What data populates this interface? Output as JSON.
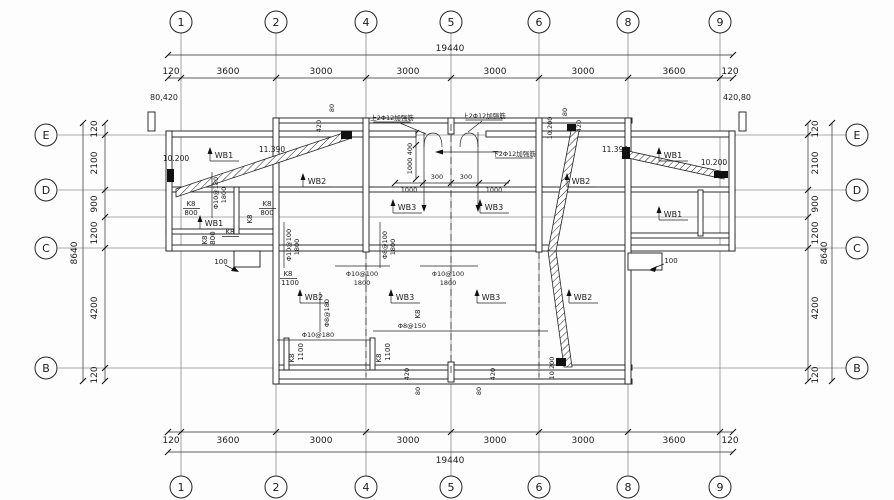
{
  "drawing": {
    "background": "#fdfdfd",
    "line_color": "#1a1a1a",
    "axis": {
      "cols": [
        {
          "label": "1",
          "x": 181
        },
        {
          "label": "2",
          "x": 276
        },
        {
          "label": "4",
          "x": 366
        },
        {
          "label": "5",
          "x": 451
        },
        {
          "label": "6",
          "x": 539
        },
        {
          "label": "8",
          "x": 628
        },
        {
          "label": "9",
          "x": 720
        }
      ],
      "rows": [
        {
          "label": "E",
          "y": 135
        },
        {
          "label": "D",
          "y": 190
        },
        {
          "label": "C",
          "y": 248
        },
        {
          "label": "B",
          "y": 368
        }
      ],
      "sub_rows": [
        217
      ]
    },
    "dims": {
      "top": {
        "total": {
          "t": "19440",
          "line_y": 55,
          "text_y": 51,
          "text_x": 450,
          "ticks": [
            168,
            733
          ]
        },
        "segments": {
          "line_y": 78,
          "text_y": 74,
          "ticks": [
            168,
            181,
            276,
            366,
            451,
            539,
            628,
            720,
            733
          ],
          "labels": [
            {
              "t": "120",
              "x": 171
            },
            {
              "t": "3600",
              "x": 228
            },
            {
              "t": "3000",
              "x": 321
            },
            {
              "t": "3000",
              "x": 408
            },
            {
              "t": "3000",
              "x": 495
            },
            {
              "t": "3000",
              "x": 583
            },
            {
              "t": "3600",
              "x": 674
            },
            {
              "t": "120",
              "x": 730
            }
          ]
        }
      },
      "bottom": {
        "segments": {
          "line_y": 432,
          "text_y": 443,
          "ticks": [
            168,
            181,
            276,
            366,
            451,
            539,
            628,
            720,
            733
          ],
          "labels": [
            {
              "t": "120",
              "x": 171
            },
            {
              "t": "3600",
              "x": 228
            },
            {
              "t": "3000",
              "x": 321
            },
            {
              "t": "3000",
              "x": 408
            },
            {
              "t": "3000",
              "x": 495
            },
            {
              "t": "3000",
              "x": 583
            },
            {
              "t": "3600",
              "x": 674
            },
            {
              "t": "120",
              "x": 730
            }
          ]
        },
        "total": {
          "t": "19440",
          "line_y": 452,
          "text_y": 463,
          "text_x": 450,
          "ticks": [
            168,
            733
          ]
        }
      },
      "left": {
        "segments": {
          "line_x": 105,
          "text_x": 97,
          "ticks": [
            123,
            135,
            190,
            217,
            248,
            368,
            381
          ],
          "labels": [
            {
              "t": "120",
              "y": 129
            },
            {
              "t": "2100",
              "y": 163
            },
            {
              "t": "900",
              "y": 204
            },
            {
              "t": "1200",
              "y": 233
            },
            {
              "t": "4200",
              "y": 308
            },
            {
              "t": "120",
              "y": 375
            }
          ]
        },
        "total": {
          "t": "8640",
          "line_x": 83,
          "text_x": 77,
          "text_y": 253,
          "ticks": [
            123,
            381
          ]
        }
      },
      "right": {
        "segments": {
          "line_x": 808,
          "text_x": 818,
          "ticks": [
            123,
            135,
            190,
            217,
            248,
            368,
            381
          ],
          "labels": [
            {
              "t": "120",
              "y": 129
            },
            {
              "t": "2100",
              "y": 163
            },
            {
              "t": "900",
              "y": 204
            },
            {
              "t": "1200",
              "y": 233
            },
            {
              "t": "4200",
              "y": 308
            },
            {
              "t": "120",
              "y": 375
            }
          ]
        },
        "total": {
          "t": "8640",
          "line_x": 832,
          "text_x": 827,
          "text_y": 253,
          "ticks": [
            123,
            381
          ]
        }
      },
      "corner_notes": [
        {
          "t": "80,420",
          "x": 164,
          "y": 100
        },
        {
          "t": "420,80",
          "x": 737,
          "y": 100
        }
      ]
    },
    "plan_labels": [
      {
        "t": "10.200",
        "x": 176,
        "y": 161,
        "fs": 7.5
      },
      {
        "t": "WB1",
        "x": 224,
        "y": 158,
        "wb": 1
      },
      {
        "t": "11.390",
        "x": 272,
        "y": 152,
        "fs": 7.5
      },
      {
        "t": "WB2",
        "x": 317,
        "y": 184,
        "wb": 1
      },
      {
        "t": "上2Φ12加强筋",
        "x": 392,
        "y": 120,
        "fs": 6.5,
        "ul": 1
      },
      {
        "t": "上2Φ12加强筋",
        "x": 484,
        "y": 118,
        "fs": 6.5,
        "ul": 1
      },
      {
        "t": "下2Φ12加强筋",
        "x": 514,
        "y": 156,
        "fs": 6.5,
        "ul": 1
      },
      {
        "t": "400",
        "x": 412,
        "y": 149,
        "r": 1,
        "fs": 6.5
      },
      {
        "t": "1000",
        "x": 412,
        "y": 166,
        "r": 1,
        "fs": 6.5
      },
      {
        "t": "300",
        "x": 437,
        "y": 179,
        "fs": 6.5
      },
      {
        "t": "300",
        "x": 466,
        "y": 179,
        "fs": 6.5
      },
      {
        "t": "1000",
        "x": 409,
        "y": 192,
        "fs": 6.5
      },
      {
        "t": "1000",
        "x": 494,
        "y": 192,
        "fs": 6.5
      },
      {
        "t": "80",
        "x": 334,
        "y": 108,
        "r": 1,
        "fs": 6.5
      },
      {
        "t": "420",
        "x": 321,
        "y": 126,
        "r": 1,
        "fs": 6.5
      },
      {
        "t": "10.200",
        "x": 552,
        "y": 128,
        "r": 1,
        "fs": 6.5
      },
      {
        "t": "80",
        "x": 567,
        "y": 112,
        "r": 1,
        "fs": 6.5
      },
      {
        "t": "420",
        "x": 581,
        "y": 126,
        "r": 1,
        "fs": 6.5
      },
      {
        "t": "WB2",
        "x": 581,
        "y": 184,
        "wb": 1
      },
      {
        "t": "11.390",
        "x": 615,
        "y": 152,
        "fs": 7.5
      },
      {
        "t": "WB1",
        "x": 673,
        "y": 158,
        "wb": 1
      },
      {
        "t": "10.200",
        "x": 714,
        "y": 165,
        "fs": 7.5
      },
      {
        "t": "K8",
        "x": 191,
        "y": 206,
        "fs": 7,
        "fr": 1
      },
      {
        "t": "800",
        "x": 191,
        "y": 215,
        "fs": 7
      },
      {
        "t": "K8",
        "x": 267,
        "y": 206,
        "fs": 7,
        "fr": 1
      },
      {
        "t": "800",
        "x": 267,
        "y": 215,
        "fs": 7
      },
      {
        "t": "WB1",
        "x": 214,
        "y": 226,
        "wb": 1
      },
      {
        "t": "K8",
        "x": 230,
        "y": 234,
        "fs": 7,
        "fr": 1
      },
      {
        "t": "K8",
        "x": 252,
        "y": 219,
        "r": 1,
        "fs": 7
      },
      {
        "t": "Φ10@180",
        "x": 218,
        "y": 193,
        "r": 1,
        "fs": 6.5
      },
      {
        "t": "1800",
        "x": 226,
        "y": 195,
        "r": 1,
        "fs": 6.5
      },
      {
        "t": "K8",
        "x": 207,
        "y": 240,
        "r": 1,
        "fs": 7
      },
      {
        "t": "800",
        "x": 215,
        "y": 238,
        "r": 1,
        "fs": 7
      },
      {
        "t": "WB3",
        "x": 407,
        "y": 210,
        "wb": 1
      },
      {
        "t": "WB3",
        "x": 494,
        "y": 210,
        "wb": 1
      },
      {
        "t": "WB1",
        "x": 673,
        "y": 217,
        "wb": 1
      },
      {
        "t": "100",
        "x": 221,
        "y": 264,
        "fs": 7
      },
      {
        "t": "100",
        "x": 671,
        "y": 263,
        "fs": 7
      },
      {
        "t": "Φ10@100",
        "x": 291,
        "y": 245,
        "r": 1,
        "fs": 6.5
      },
      {
        "t": "1800",
        "x": 299,
        "y": 247,
        "r": 1,
        "fs": 6.5
      },
      {
        "t": "Φ8@100",
        "x": 387,
        "y": 245,
        "r": 1,
        "fs": 6.5
      },
      {
        "t": "1800",
        "x": 395,
        "y": 247,
        "r": 1,
        "fs": 6.5
      },
      {
        "t": "Φ10@100",
        "x": 362,
        "y": 276,
        "fs": 6.5
      },
      {
        "t": "1800",
        "x": 362,
        "y": 285,
        "fs": 6.5
      },
      {
        "t": "Φ10@100",
        "x": 448,
        "y": 276,
        "fs": 6.5
      },
      {
        "t": "1800",
        "x": 448,
        "y": 285,
        "fs": 6.5
      },
      {
        "t": "K8",
        "x": 288,
        "y": 276,
        "fs": 7,
        "fr": 1
      },
      {
        "t": "1100",
        "x": 290,
        "y": 285,
        "fs": 7
      },
      {
        "t": "WB2",
        "x": 314,
        "y": 300,
        "wb": 1
      },
      {
        "t": "Φ8@180",
        "x": 329,
        "y": 313,
        "r": 1,
        "fs": 6.5
      },
      {
        "t": "Φ10@180",
        "x": 318,
        "y": 337,
        "fs": 6.5
      },
      {
        "t": "Φ8@150",
        "x": 412,
        "y": 328,
        "fs": 6.5
      },
      {
        "t": "WB3",
        "x": 405,
        "y": 300,
        "wb": 1
      },
      {
        "t": "WB3",
        "x": 491,
        "y": 300,
        "wb": 1
      },
      {
        "t": "K8",
        "x": 420,
        "y": 314,
        "r": 1,
        "fs": 7
      },
      {
        "t": "K8",
        "x": 294,
        "y": 358,
        "r": 1,
        "fs": 7
      },
      {
        "t": "1100",
        "x": 303,
        "y": 352,
        "r": 1,
        "fs": 7
      },
      {
        "t": "K8",
        "x": 381,
        "y": 358,
        "r": 1,
        "fs": 7
      },
      {
        "t": "1100",
        "x": 390,
        "y": 352,
        "r": 1,
        "fs": 7
      },
      {
        "t": "WB2",
        "x": 583,
        "y": 300,
        "wb": 1
      },
      {
        "t": "10.200",
        "x": 554,
        "y": 368,
        "r": 1,
        "fs": 6.5
      },
      {
        "t": "420",
        "x": 409,
        "y": 374,
        "r": 1,
        "fs": 6.5
      },
      {
        "t": "80",
        "x": 420,
        "y": 391,
        "r": 1,
        "fs": 6.5
      },
      {
        "t": "420",
        "x": 495,
        "y": 374,
        "r": 1,
        "fs": 6.5
      },
      {
        "t": "80",
        "x": 481,
        "y": 391,
        "r": 1,
        "fs": 6.5
      }
    ]
  }
}
